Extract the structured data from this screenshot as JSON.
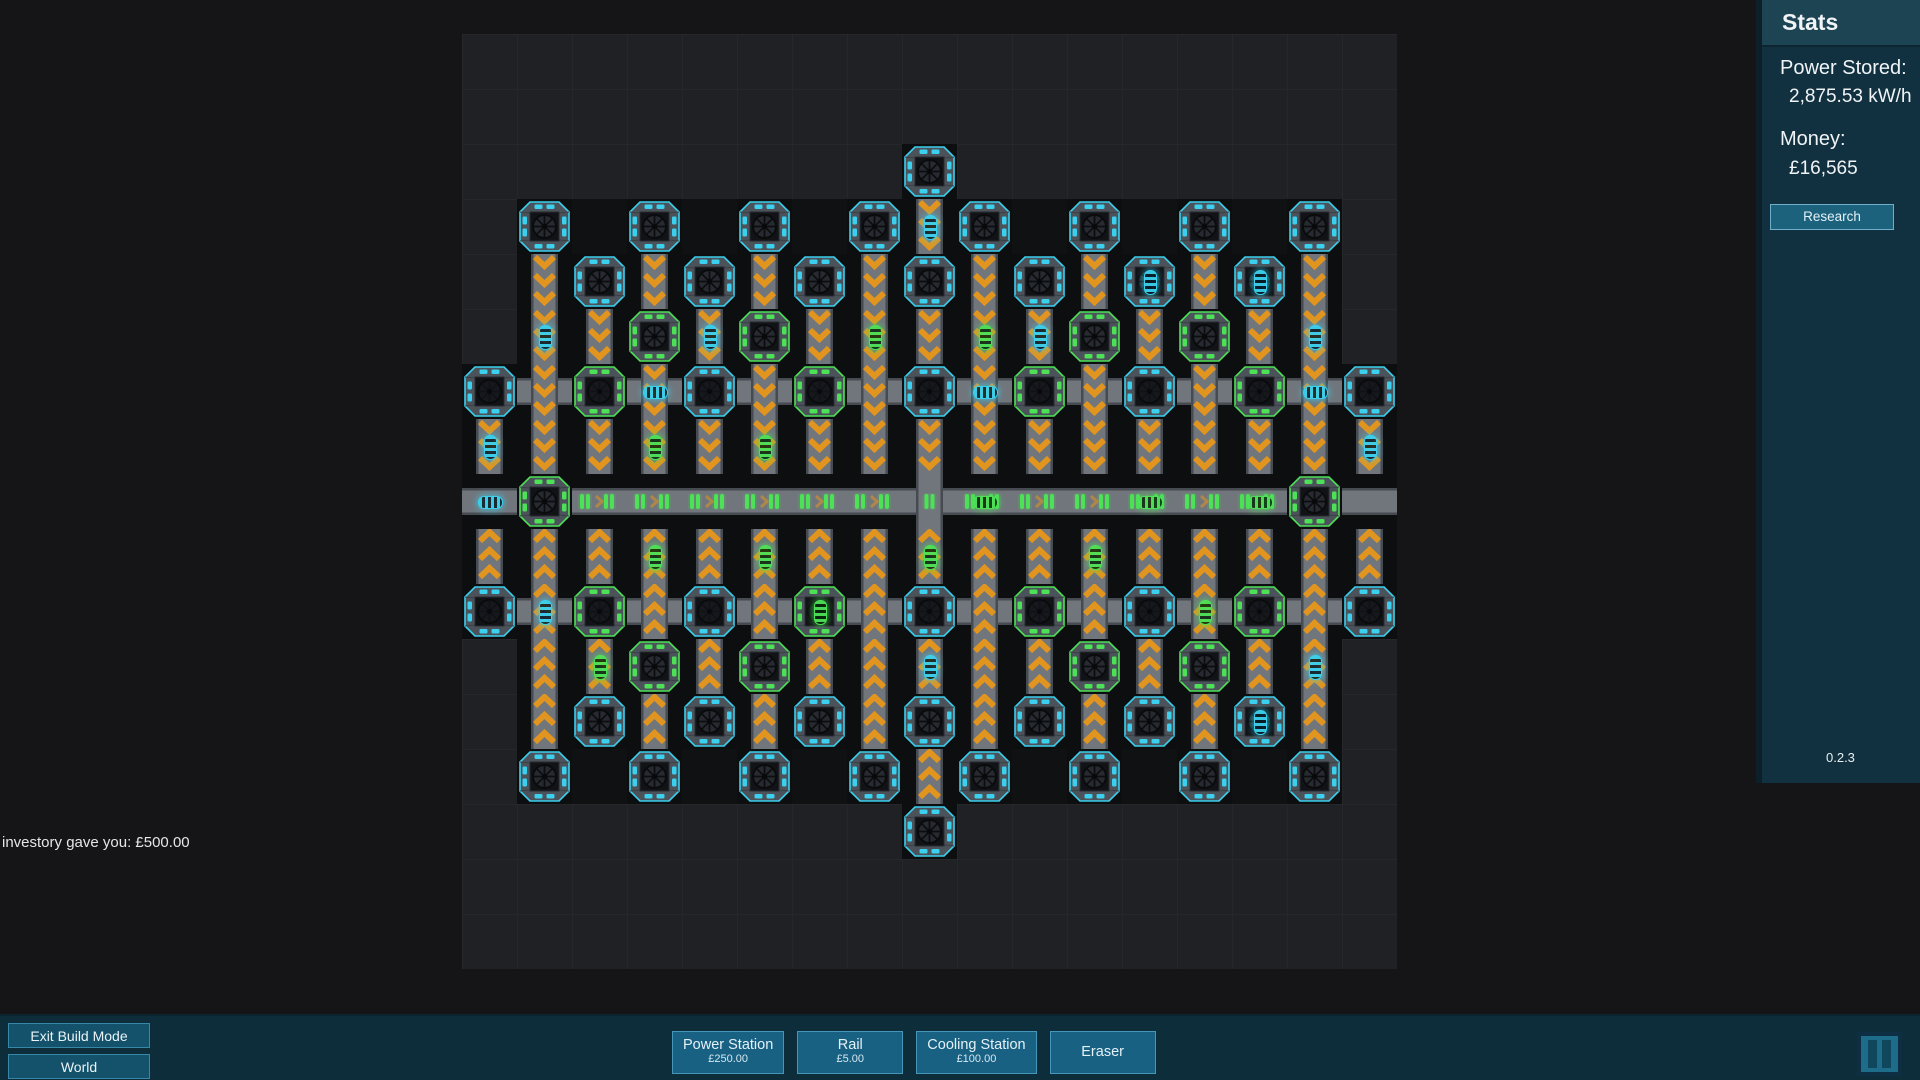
{
  "stats_panel": {
    "title": "Stats",
    "power_label": "Power Stored:",
    "power_value": "2,875.53 kW/h",
    "money_label": "Money:",
    "money_value": "£16,565",
    "research_label": "Research",
    "version": "0.2.3"
  },
  "toolbar": {
    "exit_label": "Exit Build Mode",
    "world_label": "World",
    "build_buttons": [
      {
        "name": "power-station-button",
        "label": "Power Station",
        "price": "£250.00"
      },
      {
        "name": "rail-button",
        "label": "Rail",
        "price": "£5.00"
      },
      {
        "name": "cooling-station-button",
        "label": "Cooling Station",
        "price": "£100.00"
      },
      {
        "name": "eraser-button",
        "label": "Eraser",
        "price": ""
      }
    ],
    "pause_icon": "pause-icon"
  },
  "notification": "investory gave you: £500.00",
  "colors": {
    "cyan": "#3ad0ee",
    "green": "#4ce156",
    "orange": "#e2951e",
    "track": "#71767c",
    "track_edge": "#464b51",
    "frame": "#4c525a",
    "cell_dark": "#0d0e10"
  },
  "board": {
    "cols": 17,
    "rows": 17,
    "cell": 55,
    "origin_x": 462,
    "origin_y": 34,
    "legend": {
      ".": "empty",
      "C": "station-cyan",
      "G": "station-green-bright",
      "D": "station-dark-cyan",
      "E": "station-dark-green",
      "v": "rail-vertical-down",
      "^": "rail-vertical-up",
      "h": "rail-horizontal",
      "H": "conveyor-green-items",
      "+": "rail-cross-down",
      "*": "rail-cross-up",
      "X": "conveyor-cross"
    },
    "map": [
      ".................",
      ".................",
      "........C........",
      ".C.C.C.CvC.C.C.C.",
      ".vCvCvCvCvCvCvCv.",
      ".vvGvGvvvvvGvGvv.",
      "D+E+D+E+D+E+D+E+D",
      "vvvvvvvvvvvvvvvvv",
      "hGHHHHHHXHHHHHHGh",
      "^^^^^^^^^^^^^^^^^",
      "D*E*D*E*D*E*D*E*D",
      ".^^G^G^^^^^G^G^^.",
      ".^C^C^C^C^C^C^C^.",
      ".C.C.C.C^C.C.C.C.",
      "........C........",
      ".................",
      "................."
    ],
    "items": {
      "cyan_v": [
        [
          1,
          5
        ],
        [
          4,
          5
        ],
        [
          8,
          3
        ],
        [
          10,
          5
        ],
        [
          12,
          4
        ],
        [
          14,
          4
        ],
        [
          15,
          5
        ],
        [
          0,
          7
        ],
        [
          16,
          7
        ],
        [
          8,
          11
        ],
        [
          14,
          12
        ],
        [
          15,
          11
        ],
        [
          1,
          10
        ]
      ],
      "cyan_h": [
        [
          0,
          8
        ],
        [
          9,
          6
        ],
        [
          15,
          6
        ],
        [
          3,
          6
        ]
      ],
      "green_v": [
        [
          3,
          7
        ],
        [
          7,
          5
        ],
        [
          9,
          5
        ],
        [
          5,
          7
        ],
        [
          3,
          9
        ],
        [
          5,
          9
        ],
        [
          11,
          9
        ],
        [
          6,
          10
        ],
        [
          2,
          11
        ],
        [
          8,
          9
        ],
        [
          13,
          10
        ]
      ],
      "green_h": [
        [
          9,
          8
        ],
        [
          12,
          8
        ],
        [
          14,
          8
        ]
      ]
    }
  }
}
